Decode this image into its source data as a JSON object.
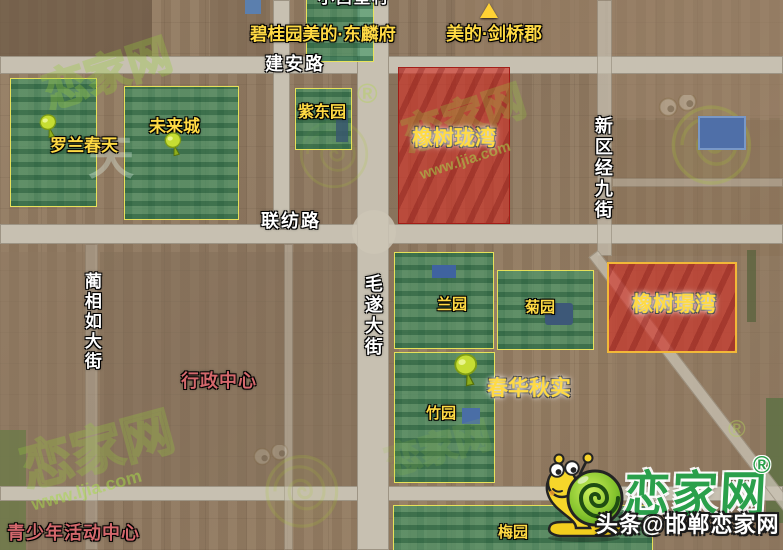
{
  "map": {
    "village_label": "小西堡村",
    "roads": [
      {
        "name": "建安路",
        "orientation": "horizontal"
      },
      {
        "name": "联纺路",
        "orientation": "horizontal"
      },
      {
        "name": "毛遂大街",
        "orientation": "vertical"
      },
      {
        "name": "蔺相如大街",
        "orientation": "vertical"
      },
      {
        "name": "新区经九街",
        "orientation": "vertical"
      }
    ],
    "projects": [
      {
        "name": "碧桂园美的·东麟府",
        "marker": "boundary-box"
      },
      {
        "name": "美的·剑桥郡",
        "marker": "triangle"
      },
      {
        "name": "春华秋实",
        "marker": "pin"
      }
    ],
    "green_areas": [
      {
        "name": "罗兰春天",
        "pin": true
      },
      {
        "name": "未来城",
        "pin": true
      },
      {
        "name": "紫东园",
        "pin": false
      },
      {
        "name": "兰园",
        "pin": false
      },
      {
        "name": "菊园",
        "pin": false
      },
      {
        "name": "竹园",
        "pin": false
      },
      {
        "name": "梅园",
        "pin": false
      }
    ],
    "red_areas": [
      {
        "name": "橡树珑湾"
      },
      {
        "name": "橡树璟湾"
      }
    ],
    "pois": [
      {
        "name": "行政中心"
      },
      {
        "name": "青少年活动中心"
      }
    ]
  },
  "watermark": {
    "site_name": "恋家网",
    "site_url": "www.ljia.com",
    "registered": "®",
    "ghost_glyph": "天"
  },
  "branding": {
    "logo_text": "恋家网",
    "registered": "®",
    "credit": "头条@邯郸恋家网",
    "logo_color": "#2aa04b"
  },
  "colors": {
    "green_area_fill": "rgba(58,142,94,0.62)",
    "green_area_border": "#efe75a",
    "red_area_fill": "rgba(210,45,35,0.62)",
    "red_area_border_jingwan": "#f2b838",
    "label_yellow": "#ffda44",
    "poi_label_red": "#d4686c"
  }
}
